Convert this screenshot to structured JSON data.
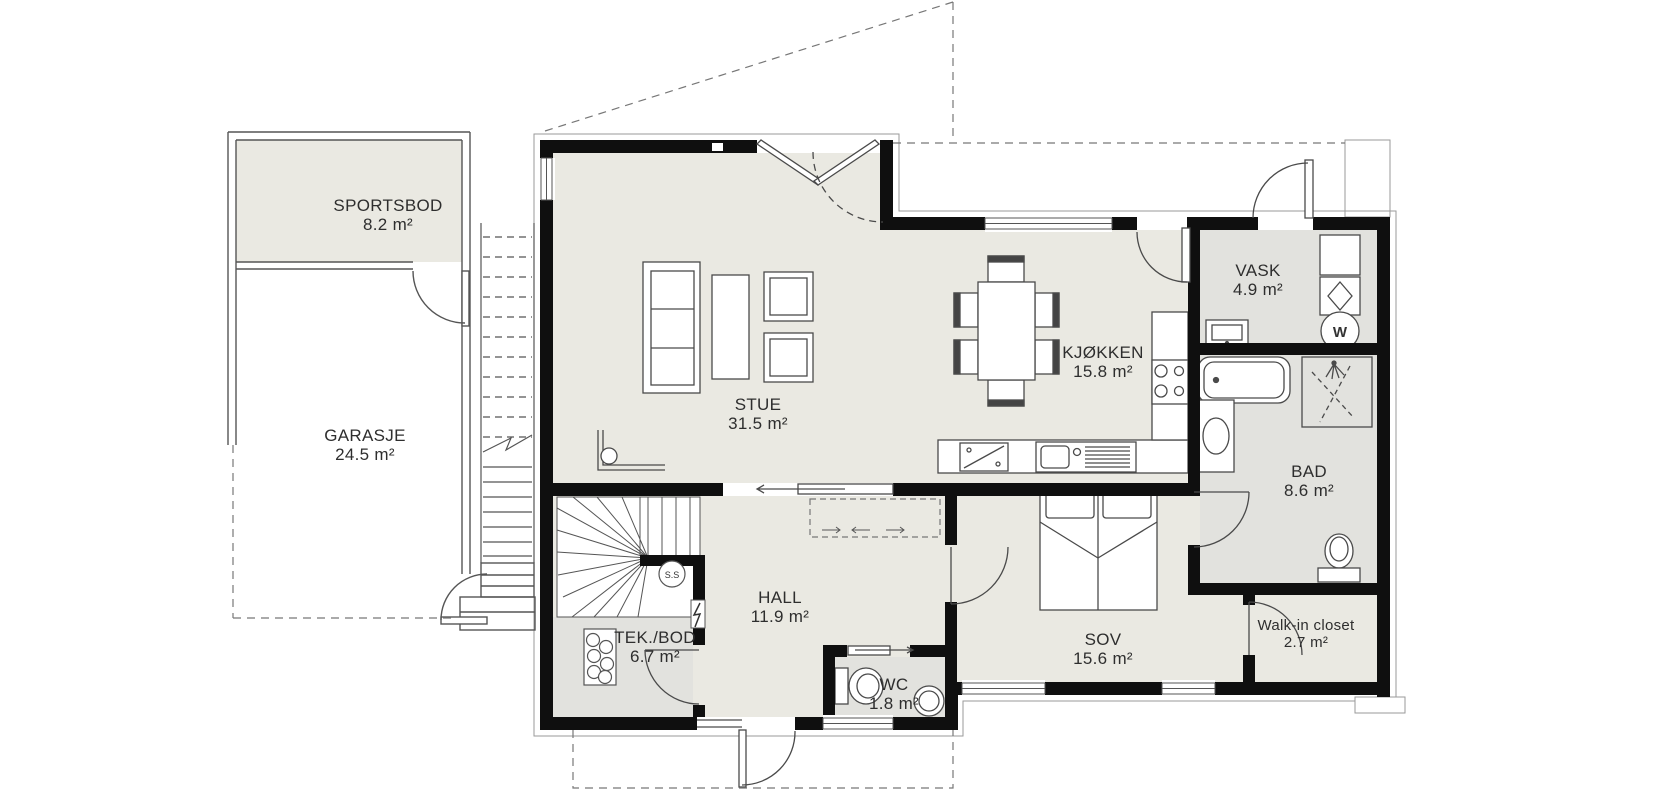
{
  "plan": {
    "rooms": [
      {
        "name": "SPORTSBOD",
        "area": "8.2 m²"
      },
      {
        "name": "GARASJE",
        "area": "24.5 m²"
      },
      {
        "name": "STUE",
        "area": "31.5 m²"
      },
      {
        "name": "KJØKKEN",
        "area": "15.8 m²"
      },
      {
        "name": "VASK",
        "area": "4.9 m²"
      },
      {
        "name": "BAD",
        "area": "8.6 m²"
      },
      {
        "name": "HALL",
        "area": "11.9 m²"
      },
      {
        "name": "TEK./BOD",
        "area": "6.7 m²"
      },
      {
        "name": "WC",
        "area": "1.8 m²"
      },
      {
        "name": "SOV",
        "area": "15.6 m²"
      },
      {
        "name": "Walk-in closet",
        "area": "2.7 m²"
      }
    ],
    "symbols": {
      "washer": "W",
      "stair": "S.S"
    },
    "colors": {
      "wall": "#0f0f0f",
      "room_fill": "#eae9e2",
      "wet_fill": "#e2e2de",
      "line": "#4a4a4a",
      "dash": "#777777"
    }
  }
}
